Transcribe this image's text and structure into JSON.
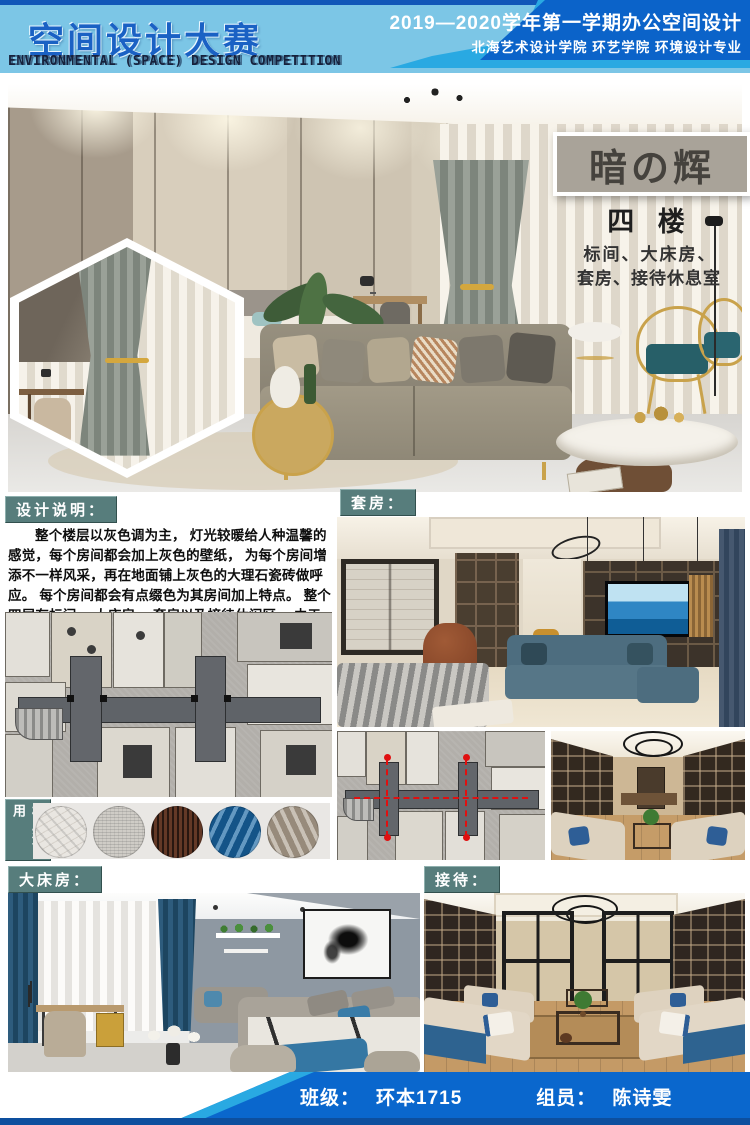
{
  "header": {
    "title_cn": "空间设计大赛",
    "title_en": "ENVIRONMENTAL (SPACE) DESIGN  COMPETITION",
    "term_line": "2019—2020学年第一学期办公空间设计",
    "school_line": "北海艺术设计学院  环艺学院  环境设计专业"
  },
  "hero": {
    "project_title": "暗の辉",
    "floor_label": "四  楼",
    "rooms_line1": "标间、大床房、",
    "rooms_line2": "套房、接待休息室"
  },
  "design_note": {
    "label": "设计说明：",
    "text": "整个楼层以灰色调为主， 灯光较暖给人种温馨的感觉，每个房间都会加上灰色的壁纸， 为每个房间增添不一样风采，再在地面铺上灰色的大理石瓷砖做呼应。 每个房间都会有点缀色为其房间加上特点。 整个四层有标间、 大床房、 套房以及接待休闲区。 由于楼增高， 它的采光性， 私密性等特点都会非常好。"
  },
  "section_labels": {
    "suite": "套房：",
    "materials": "材质运用",
    "king_room": "大床房：",
    "reception": "接待："
  },
  "materials": {
    "swatches": [
      "white-marble",
      "gray-wallpaper",
      "dark-wood-grain",
      "blue-fabric",
      "taupe-fabric"
    ]
  },
  "footer": {
    "class_label": "班级：",
    "class_value": "环本1715",
    "member_label": "组员：",
    "member_value": "陈诗雯"
  },
  "colors": {
    "header_light_blue": "#7cc6e6",
    "header_dark_blue": "#0b63c9",
    "accent_cyan": "#29a9e2",
    "label_teal": "#577d7c",
    "title_block_bg": "#a9a399",
    "title_block_text": "#45423d",
    "footer_blue": "#0a67cd",
    "footer_bottom_strip": "#0d4f9e"
  }
}
